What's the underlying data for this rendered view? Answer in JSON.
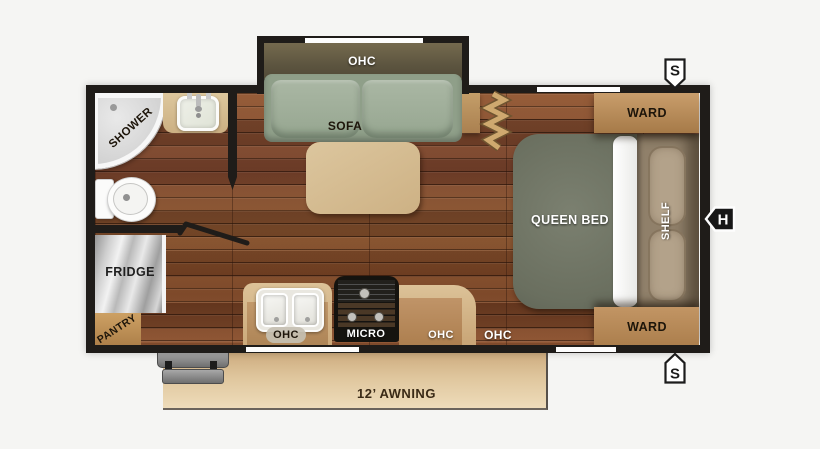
{
  "plan": {
    "living_area": {
      "ohc": "OHC",
      "sofa": "SOFA"
    },
    "bathroom": {
      "shower": "SHOWER"
    },
    "kitchen": {
      "fridge": "FRIDGE",
      "pantry": "PANTRY",
      "sink_ohc": "OHC",
      "micro": "MICRO",
      "counter_ohc": "OHC",
      "overhead_ohc": "OHC"
    },
    "bedroom": {
      "bed": "QUEEN BED",
      "shelf": "SHELF",
      "ward_front": "WARD",
      "ward_rear": "WARD"
    },
    "exterior": {
      "awning": "12’ AWNING",
      "speaker_front": "S",
      "speaker_rear": "S",
      "hookup": "H"
    },
    "colors": {
      "wall": "#1f1c19",
      "floor_wood": "#7c4526",
      "sofa": "#a5b29e",
      "ohc_cabinet": "#675d43",
      "table": "#d6bf97",
      "bed": "#6f7464",
      "shelf": "#90806a",
      "ward": "#b98a57",
      "counter": "#d2b283",
      "awning": "#dfc69d",
      "background": "#f5f5f3"
    }
  }
}
